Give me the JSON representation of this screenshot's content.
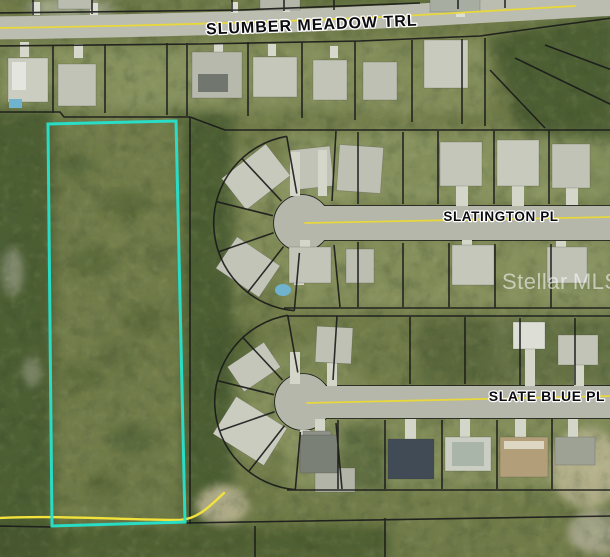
{
  "map": {
    "street_labels": [
      {
        "id": "slumber-meadow-trl",
        "text": "SLUMBER MEADOW TRL"
      },
      {
        "id": "slatington-pl",
        "text": "SLATINGTON PL"
      },
      {
        "id": "slate-blue-pl",
        "text": "SLATE BLUE PL"
      }
    ],
    "watermark": {
      "brand": "Stellar",
      "suffix": "MLS",
      "tm": "™"
    },
    "subject_parcel": {
      "outline_color": "#27e0ca"
    },
    "colors": {
      "road_centerline_yellow": "#e8d73d",
      "access_track_yellow": "#f3e23c",
      "parcel_boundary_black": "#1a1a1a",
      "road_surface_gray": "#b7baad"
    }
  }
}
